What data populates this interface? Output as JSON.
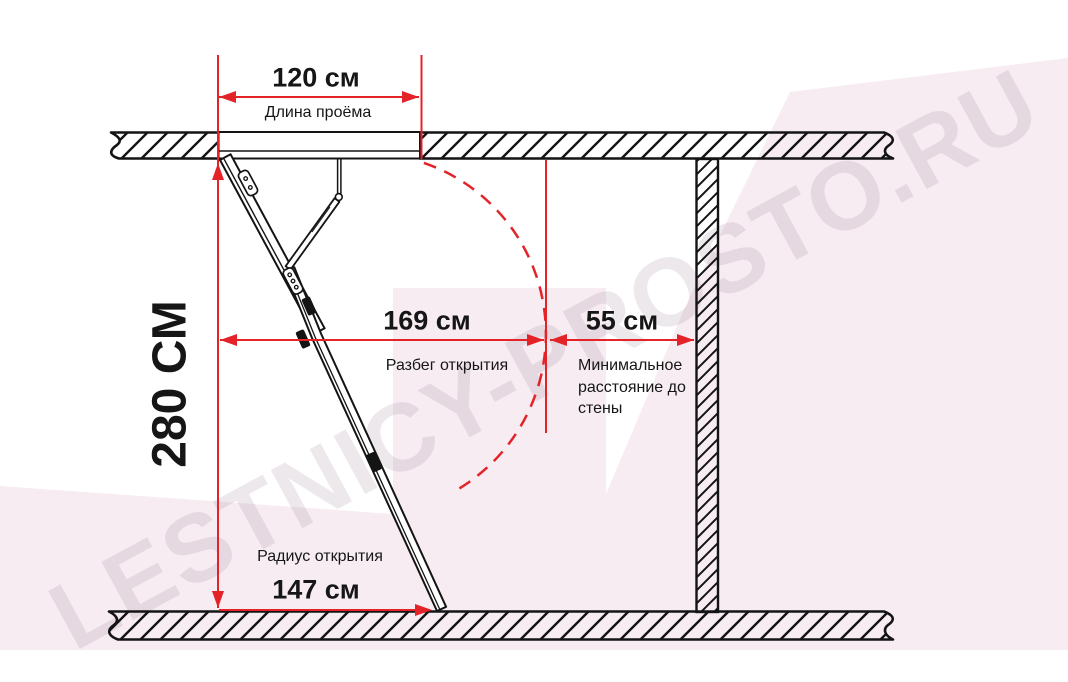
{
  "diagram": {
    "watermark": "LESTNICY-PROSTO.RU",
    "dims": {
      "opening_length": {
        "value": "120 см",
        "label": "Длина проёма"
      },
      "height": {
        "value": "280 СМ"
      },
      "run": {
        "value": "169 см",
        "label": "Разбег открытия"
      },
      "wall": {
        "value": "55 см",
        "label": "Минимальное расстояние до стены"
      },
      "radius": {
        "value": "147 см",
        "label": "Радиус открытия"
      }
    },
    "colors": {
      "dimension_red": "#e32328",
      "linework_black": "#141414",
      "tint_pink": "#f7ecf2"
    }
  }
}
